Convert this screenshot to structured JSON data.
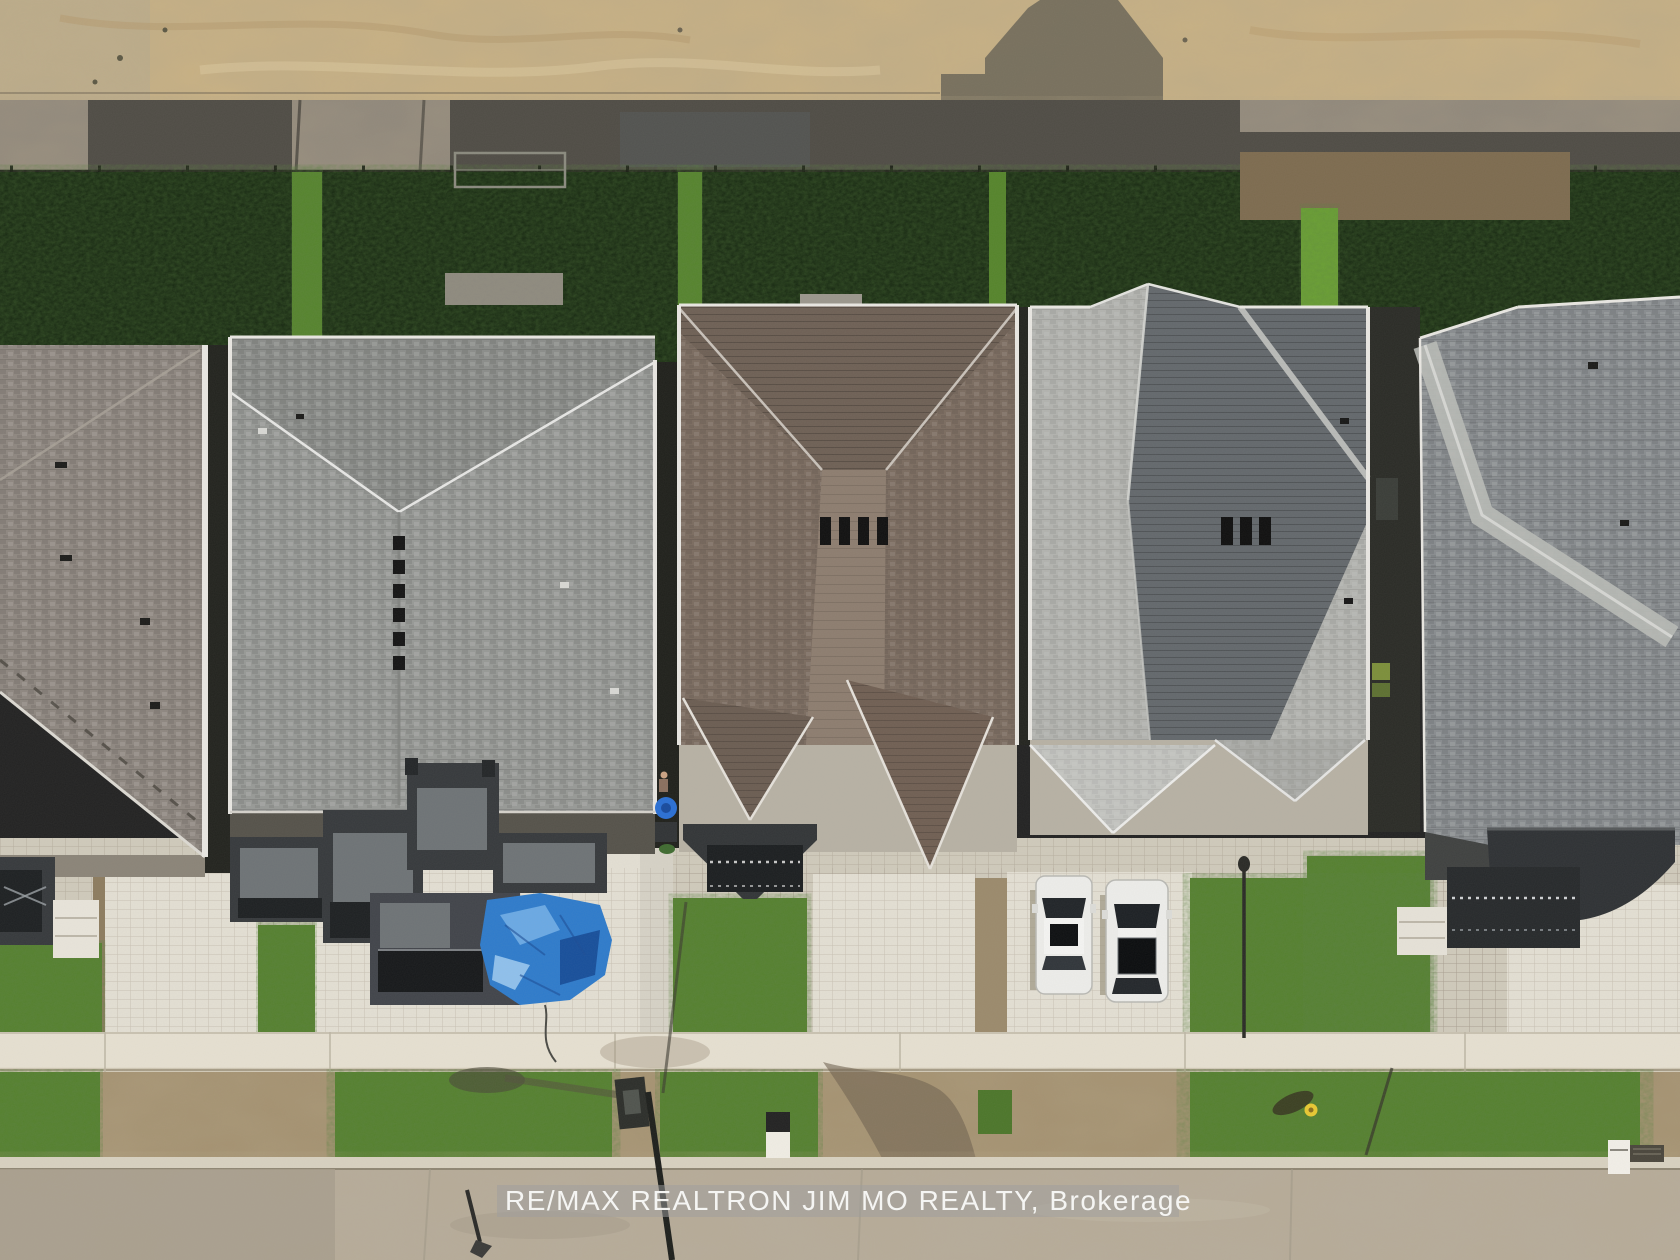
{
  "image": {
    "kind": "aerial-drone-photo",
    "description": "Top-down (nadir) drone photograph of a row of five newly built detached houses in a new subdivision: graded sand construction strip at top, dark shaded backyards with sunlit green gaps between lots, five shingled rooftops, interlock paver driveways, front lawns, a concrete sidewalk, a grass-and-dirt boulevard and a concrete road at bottom.",
    "width_px": 1680,
    "height_px": 1260
  },
  "watermark": {
    "text": "RE/MAX REALTRON JIM MO REALTY, Brokerage"
  },
  "scene": {
    "houses": [
      {
        "id": 1,
        "position": "far-left, partially cropped",
        "roof": "gray-taupe hip roof with dark step flashing",
        "front": "dark covered porch with railing, white steps, paver driveway"
      },
      {
        "id": 2,
        "position": "second from left",
        "roof": "light gray architectural shingles, long center ridge with six black roof vents, V-shaped hip valley at rear",
        "front": "staggered charcoal flat porch roofs, blue tarp on paver patio"
      },
      {
        "id": 3,
        "position": "center",
        "roof": "brown shingles, two front gables, charcoal porch roof with railed porch",
        "front": "paver driveway, lawn, recycling bins and a person beside the house"
      },
      {
        "id": 4,
        "position": "second from right",
        "roof": "two-tone gray hip roof with dark rear slope, peak offset, two pale front gables",
        "front": "paver driveway with two white cars, lawn"
      },
      {
        "id": 5,
        "position": "far-right, partially cropped",
        "roof": "gray shingles with pale diagonal hip band, curved charcoal porch roof",
        "front": "railed porch, white steps, paver driveway to image edge"
      }
    ],
    "cars": [
      {
        "color": "white",
        "type": "sedan",
        "location": "driveway of house 4, left space"
      },
      {
        "color": "white",
        "type": "sedan with large black sunroof",
        "location": "driveway of house 4, right space"
      }
    ],
    "objects": [
      "house-shaped shadow cast on sand strip at top",
      "silt fence line between sand strip and backyards",
      "metal frame lying on back lawn behind house 2",
      "blue tarp on patio of house 2",
      "blue recycling bin, dark bin and person between houses 2 and 3",
      "portable basketball hoop at road edge with long shadow",
      "small for-sale sign on boulevard",
      "yellow fire hydrant with shadow on right boulevard",
      "small white sign on right boulevard",
      "streetlight pole on boulevard near house 4",
      "storm drain at right curb",
      "dirt streak crossing boulevard and road"
    ],
    "ground_bands_top_to_bottom": [
      "graded sand / construction strip",
      "shaded gravel strip with silt fence",
      "dark backyard lawns with bright sunlit gaps between lots",
      "rooftops and front yards",
      "white concrete sidewalk",
      "boulevard of sod and dirt",
      "concrete road"
    ]
  },
  "colors": {
    "sand": "#c9b183",
    "gravel_shadow": "#4f4c45",
    "grass_dark": "#13240e",
    "grass_bright": "#55842b",
    "roof_gray": "#979996",
    "roof_brown": "#7b6c60",
    "roof_pale": "#b2b3af",
    "roof_dark_slope": "#63686c",
    "porch_charcoal": "#36393c",
    "pavers": "#e3dfd3",
    "sidewalk": "#e6e0d1",
    "road": "#b6ac9b",
    "tarp_blue": "#2e7bcb",
    "car_white": "#ededea",
    "hydrant_yellow": "#e8c832"
  }
}
